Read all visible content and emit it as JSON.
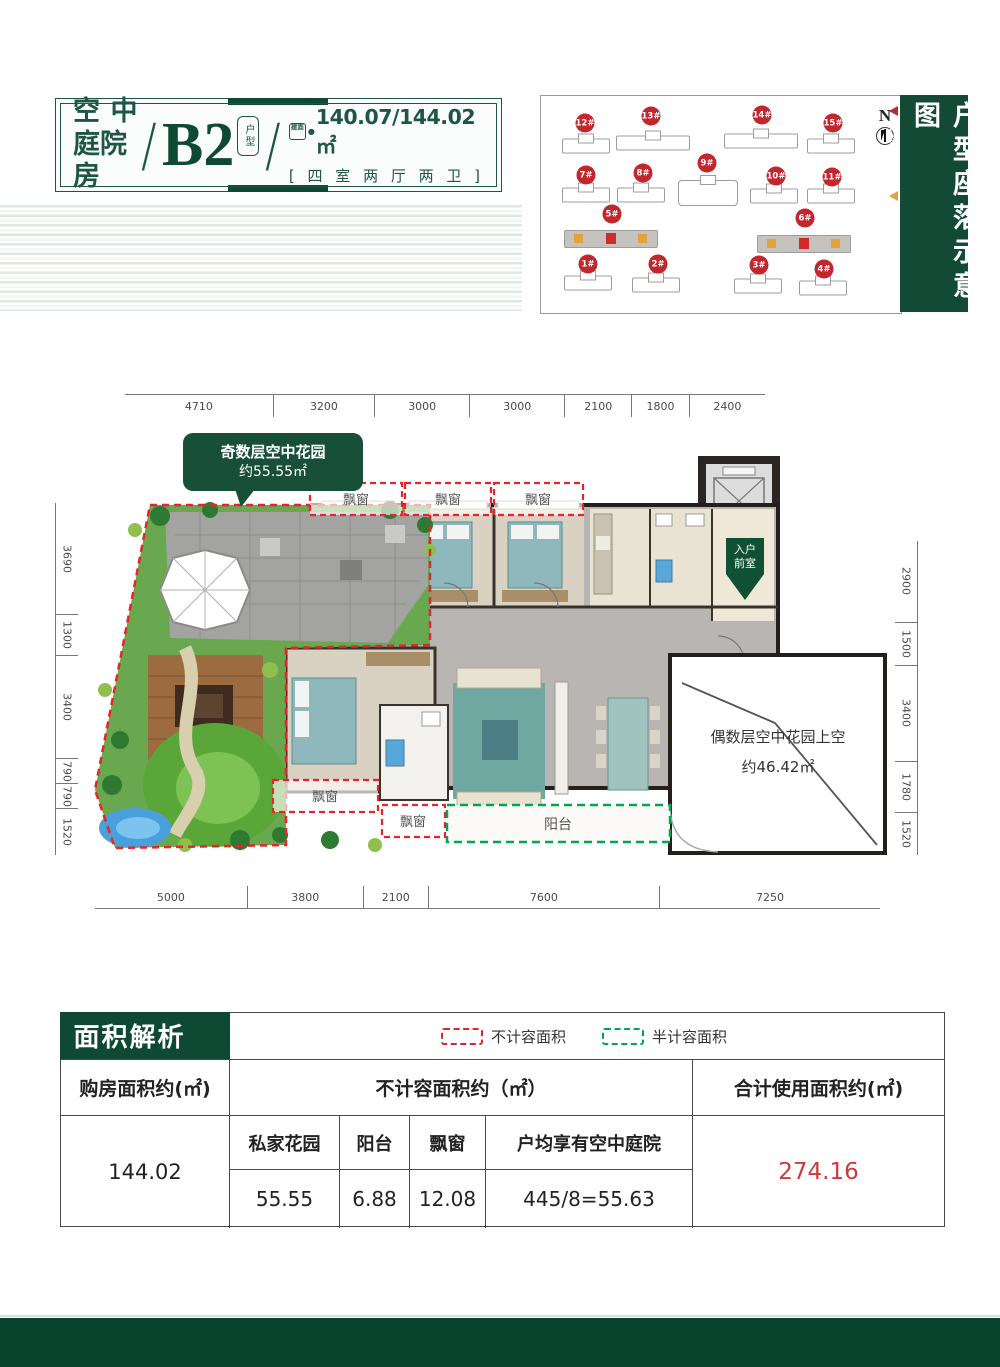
{
  "header": {
    "title_line1_a": "空",
    "title_line1_b": "中",
    "title_line2": "庭院房",
    "unit": "B2",
    "unit_seal": "户型",
    "area_stamp": "建面",
    "area_dot": "●",
    "area_value": "140.07/144.02㎡",
    "layout": "[ 四 室 两 厅 两 卫 ]"
  },
  "siteplan": {
    "title": "户型座落示意图",
    "compass": "N",
    "legend": [
      {
        "label": "奇数层花园",
        "color": "#c1272d"
      },
      {
        "label": "偶数层花园",
        "color": "#e2a33c"
      }
    ],
    "buildings": [
      {
        "id": "12#",
        "lx": 44,
        "ly": 27,
        "bx": 45,
        "by": 50,
        "cls": ""
      },
      {
        "id": "13#",
        "lx": 110,
        "ly": 20,
        "bx": 112,
        "by": 47,
        "cls": "wide"
      },
      {
        "id": "14#",
        "lx": 221,
        "ly": 19,
        "bx": 220,
        "by": 45,
        "cls": "wide"
      },
      {
        "id": "15#",
        "lx": 292,
        "ly": 27,
        "bx": 290,
        "by": 50,
        "cls": ""
      },
      {
        "id": "7#",
        "lx": 45,
        "ly": 79,
        "bx": 45,
        "by": 99,
        "cls": ""
      },
      {
        "id": "8#",
        "lx": 102,
        "ly": 77,
        "bx": 100,
        "by": 99,
        "cls": ""
      },
      {
        "id": "9#",
        "lx": 166,
        "ly": 67,
        "bx": 167,
        "by": 97,
        "cls": "ctr"
      },
      {
        "id": "10#",
        "lx": 235,
        "ly": 80,
        "bx": 233,
        "by": 100,
        "cls": ""
      },
      {
        "id": "11#",
        "lx": 291,
        "ly": 81,
        "bx": 290,
        "by": 100,
        "cls": ""
      },
      {
        "id": "5#",
        "lx": 71,
        "ly": 118,
        "bx": 70,
        "by": 143,
        "cls": "hl"
      },
      {
        "id": "6#",
        "lx": 264,
        "ly": 122,
        "bx": 263,
        "by": 148,
        "cls": "hl"
      },
      {
        "id": "1#",
        "lx": 47,
        "ly": 168,
        "bx": 47,
        "by": 187,
        "cls": ""
      },
      {
        "id": "2#",
        "lx": 117,
        "ly": 168,
        "bx": 115,
        "by": 189,
        "cls": ""
      },
      {
        "id": "3#",
        "lx": 218,
        "ly": 169,
        "bx": 217,
        "by": 190,
        "cls": ""
      },
      {
        "id": "4#",
        "lx": 283,
        "ly": 173,
        "bx": 282,
        "by": 192,
        "cls": ""
      }
    ]
  },
  "floorplan": {
    "callout": {
      "line1": "奇数层空中花园",
      "line2": "约55.55㎡"
    },
    "labels": {
      "bay_window": "飘窗",
      "balcony": "阳台",
      "entry_l1": "入户",
      "entry_l2": "前室",
      "void_line1": "偶数层空中花园上空",
      "void_line2": "约46.42㎡"
    },
    "dims_top": [
      "4710",
      "3200",
      "3000",
      "3000",
      "2100",
      "1800",
      "2400"
    ],
    "dims_bottom": [
      "5000",
      "3800",
      "2100",
      "7600",
      "7250"
    ],
    "dims_left": [
      "3690",
      "1300",
      "3400",
      "790",
      "790",
      "1520"
    ],
    "dims_right": [
      "2900",
      "1500",
      "3400",
      "1780",
      "1520"
    ]
  },
  "table": {
    "title": "面积解析",
    "legend": [
      {
        "label": "不计容面积",
        "color": "#d42a2a"
      },
      {
        "label": "半计容面积",
        "color": "#00a651"
      }
    ],
    "col1_header": "购房面积约(㎡)",
    "col2_header": "不计容面积约（㎡）",
    "col3_header": "合计使用面积约(㎡)",
    "sub_headers": [
      "私家花园",
      "阳台",
      "飘窗",
      "户均享有空中庭院"
    ],
    "sub_values": [
      "55.55",
      "6.88",
      "12.08",
      "445/8=55.63"
    ],
    "col1_value": "144.02",
    "col3_value": "274.16"
  }
}
